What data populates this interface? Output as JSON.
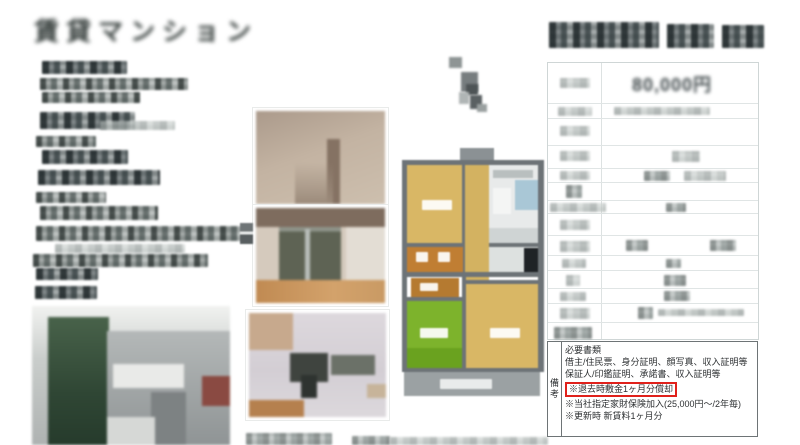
{
  "document": {
    "type_label": "賃貸マンション",
    "rent_value": "80,000円"
  },
  "remarks_box": {
    "row_header": "備考",
    "required_docs_title": "必要書類",
    "required_docs_lines": [
      "借主/住民票、身分証明、顔写真、収入証明等",
      "保証人/印鑑証明、承諾書、収入証明等"
    ],
    "highlight_note": "※退去時敷金1ヶ月分償却",
    "notes": [
      "※当社指定家財保険加入(25,000円〜/2年毎)",
      "※更新時 新賃料1ヶ月分"
    ]
  },
  "icons": {
    "cursor": "cursor-icon"
  },
  "colors": {
    "highlight_border": "#e0211b",
    "floorplan_room_tan": "#d9b765",
    "floorplan_room_green": "#7db32c",
    "floorplan_closet_orange": "#c07e33",
    "floorplan_wall_gray": "#6d7377",
    "floorplan_bath_blue": "#a9c7d6",
    "balcony_gray": "#9ba1a3"
  }
}
